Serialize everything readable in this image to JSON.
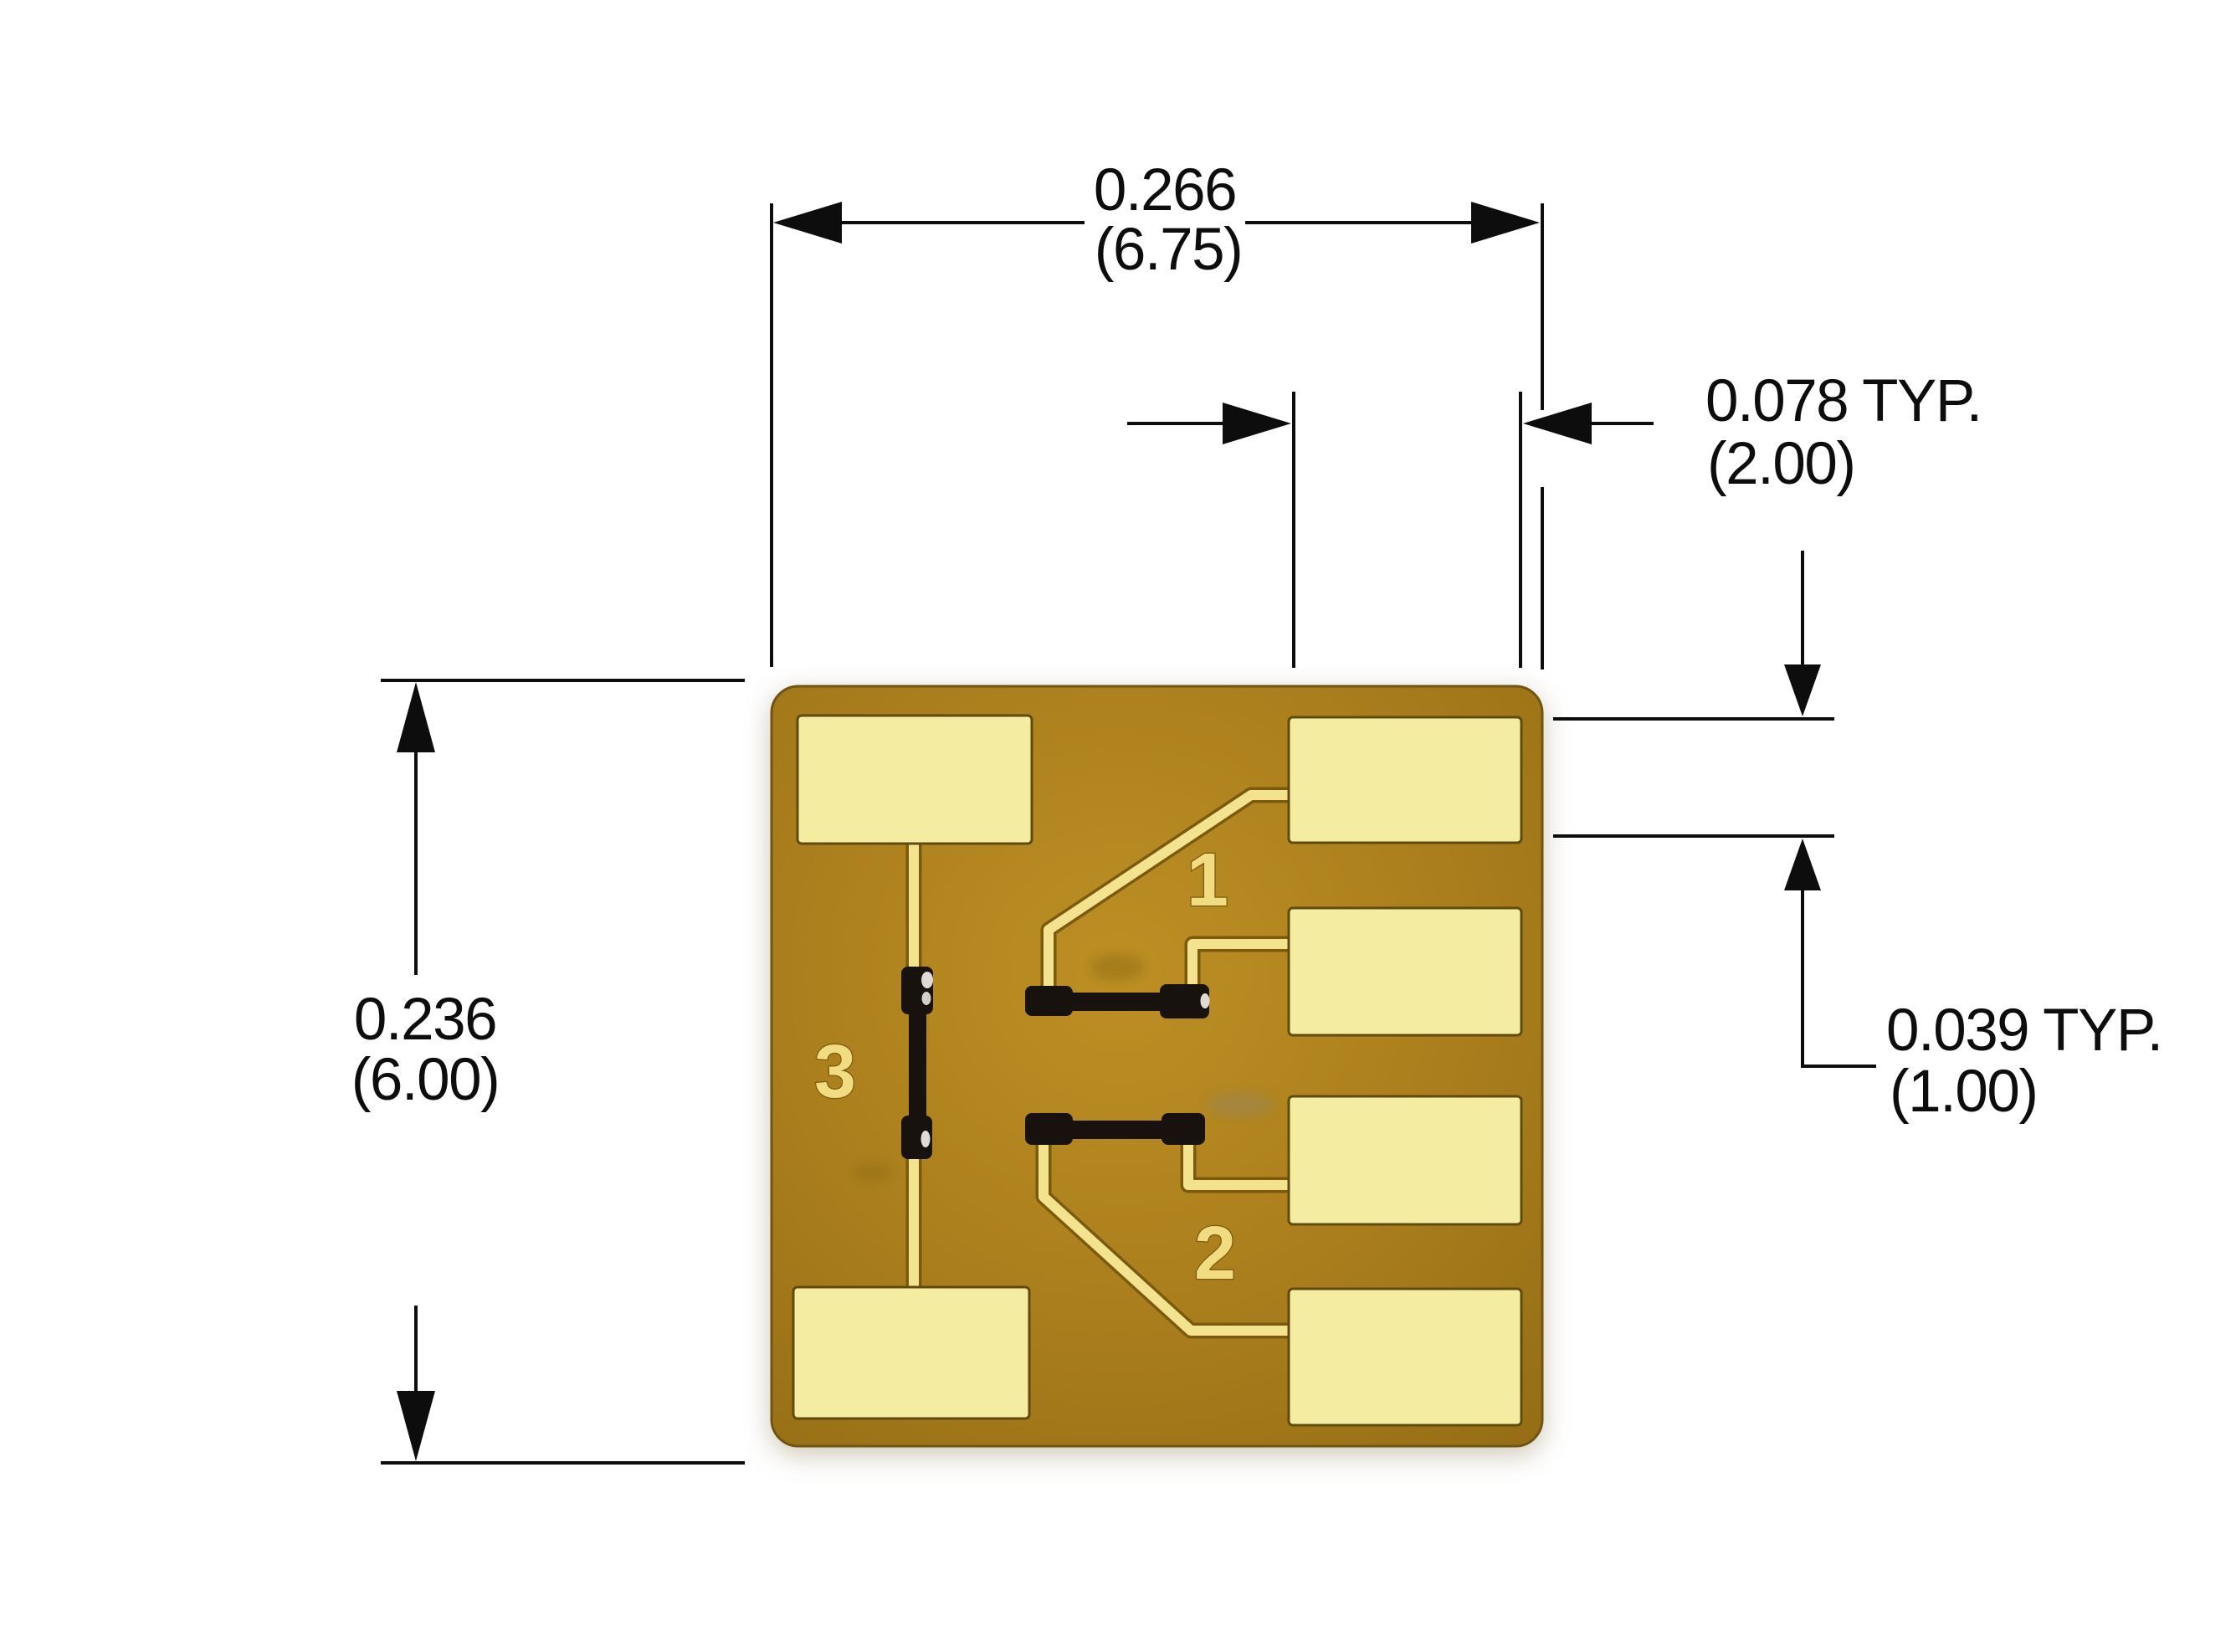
{
  "figure": {
    "kind": "mechanical dimension drawing",
    "subject": "gold-plated ceramic substrate / chip carrier, top view photo with dimension overlay",
    "units_note": "dimensions in inches with (millimeters)"
  },
  "colors": {
    "c-bg": "#ffffff",
    "c-line": "#0d0d0d",
    "c-substrate-hi": "#bd8f24",
    "c-substrate": "#a97d1c",
    "c-substrate-lo": "#936c14",
    "c-substrate-edge": "#6f5510",
    "c-pad": "#f3eca1",
    "c-pad-edge": "#5f4a10",
    "c-trace": "#f3e28e",
    "c-trace-edge": "#7a5a0e",
    "c-component": "#17120d",
    "c-pinlabel": "#f2dc82"
  },
  "dimensions": {
    "substrate_width": {
      "inches": "0.266",
      "mm": "(6.75)"
    },
    "pad_width": {
      "inches": "0.078 TYP.",
      "mm": "(2.00)"
    },
    "substrate_height": {
      "inches": "0.236",
      "mm": "(6.00)"
    },
    "pad_height": {
      "inches": "0.039 TYP.",
      "mm": "(1.00)"
    }
  },
  "substrate": {
    "pin_labels": {
      "pin1": "1",
      "pin2": "2",
      "pin3": "3"
    }
  }
}
